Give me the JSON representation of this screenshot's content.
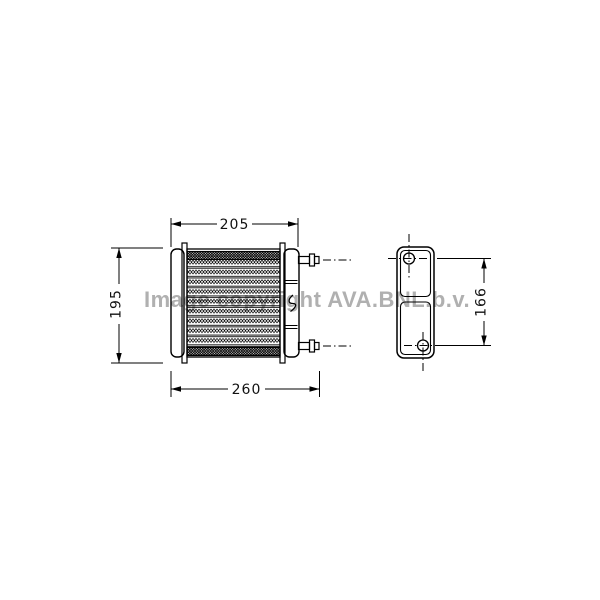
{
  "page": {
    "background_color": "#ffffff",
    "line_color": "#000000"
  },
  "watermark": {
    "text": "Image copyright AVA.BNL.b.v.",
    "color": "#b0b0b0"
  },
  "drawing": {
    "description": "technical-diagram-heater-core",
    "dimensions": {
      "top_width": {
        "value": "205"
      },
      "bottom_width": {
        "value": "260"
      },
      "left_height": {
        "value": "195"
      },
      "side_height": {
        "value": "166"
      }
    }
  }
}
